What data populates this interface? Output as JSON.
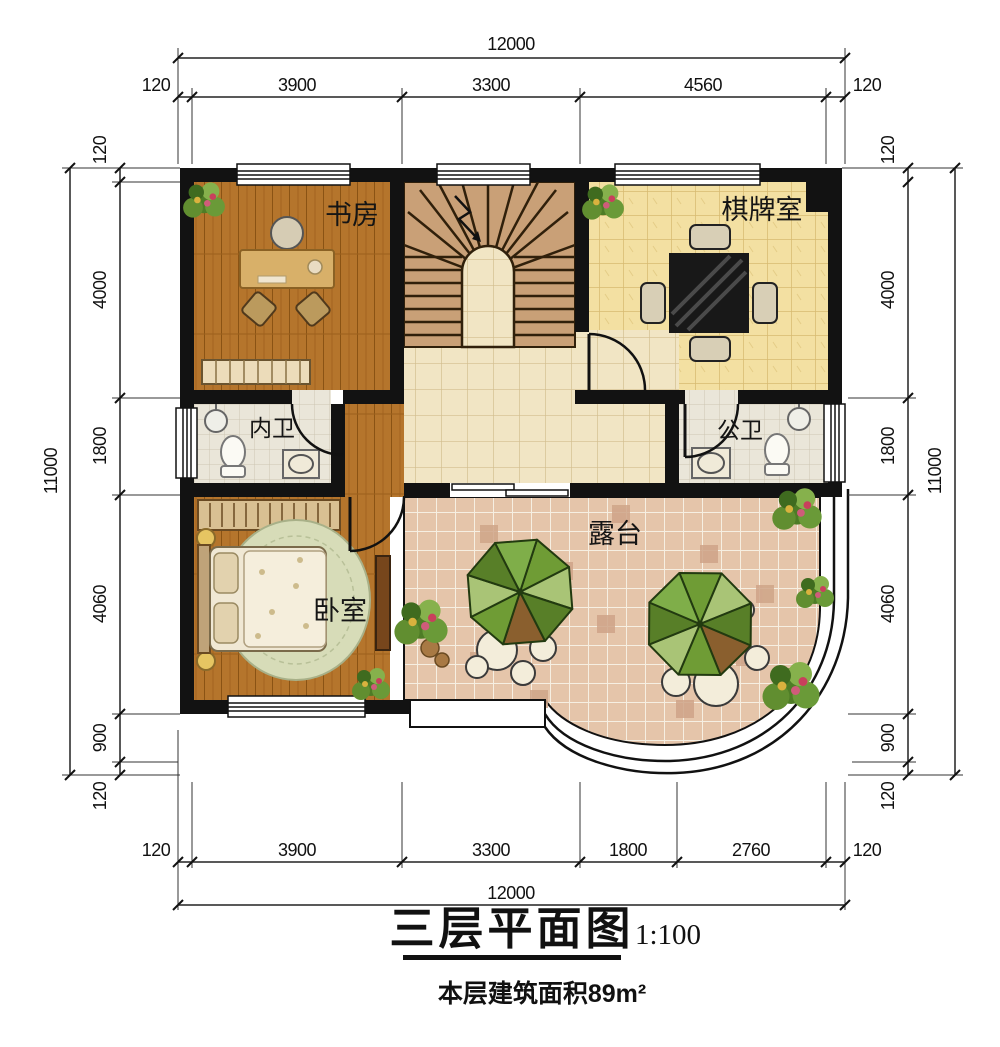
{
  "document": {
    "kind": "architectural floor plan",
    "title": "三层平面图",
    "scale": "1:100",
    "area_note": "本层建筑面积89m²"
  },
  "rooms": {
    "study": {
      "label": "书房"
    },
    "chess_room": {
      "label": "棋牌室"
    },
    "inner_bath": {
      "label": "内卫"
    },
    "public_bath": {
      "label": "公卫"
    },
    "bedroom": {
      "label": "卧室"
    },
    "terrace": {
      "label": "露台"
    }
  },
  "dimensions": {
    "top": {
      "overall": "12000",
      "segments": [
        "120",
        "3900",
        "3300",
        "4560",
        "120"
      ]
    },
    "bottom": {
      "overall": "12000",
      "segments": [
        "120",
        "3900",
        "3300",
        "1800",
        "2760",
        "120"
      ]
    },
    "left": {
      "overall": "11000",
      "segments": [
        "120",
        "4000",
        "1800",
        "4060",
        "900",
        "120"
      ]
    },
    "right": {
      "overall": "11000",
      "segments": [
        "120",
        "4000",
        "1800",
        "4060",
        "900",
        "120"
      ]
    }
  },
  "colors": {
    "wall": "#121212",
    "wood_floor": "#b5752c",
    "stair": "#c9a077",
    "chess_tile": "#f3e0a2",
    "hall_tile": "#f1e5c4",
    "bath_tile": "#eae6d9",
    "terrace_tile": "#e5c5aa",
    "umbrella_green": "#6f9c35",
    "dimension_text": "#111111"
  }
}
